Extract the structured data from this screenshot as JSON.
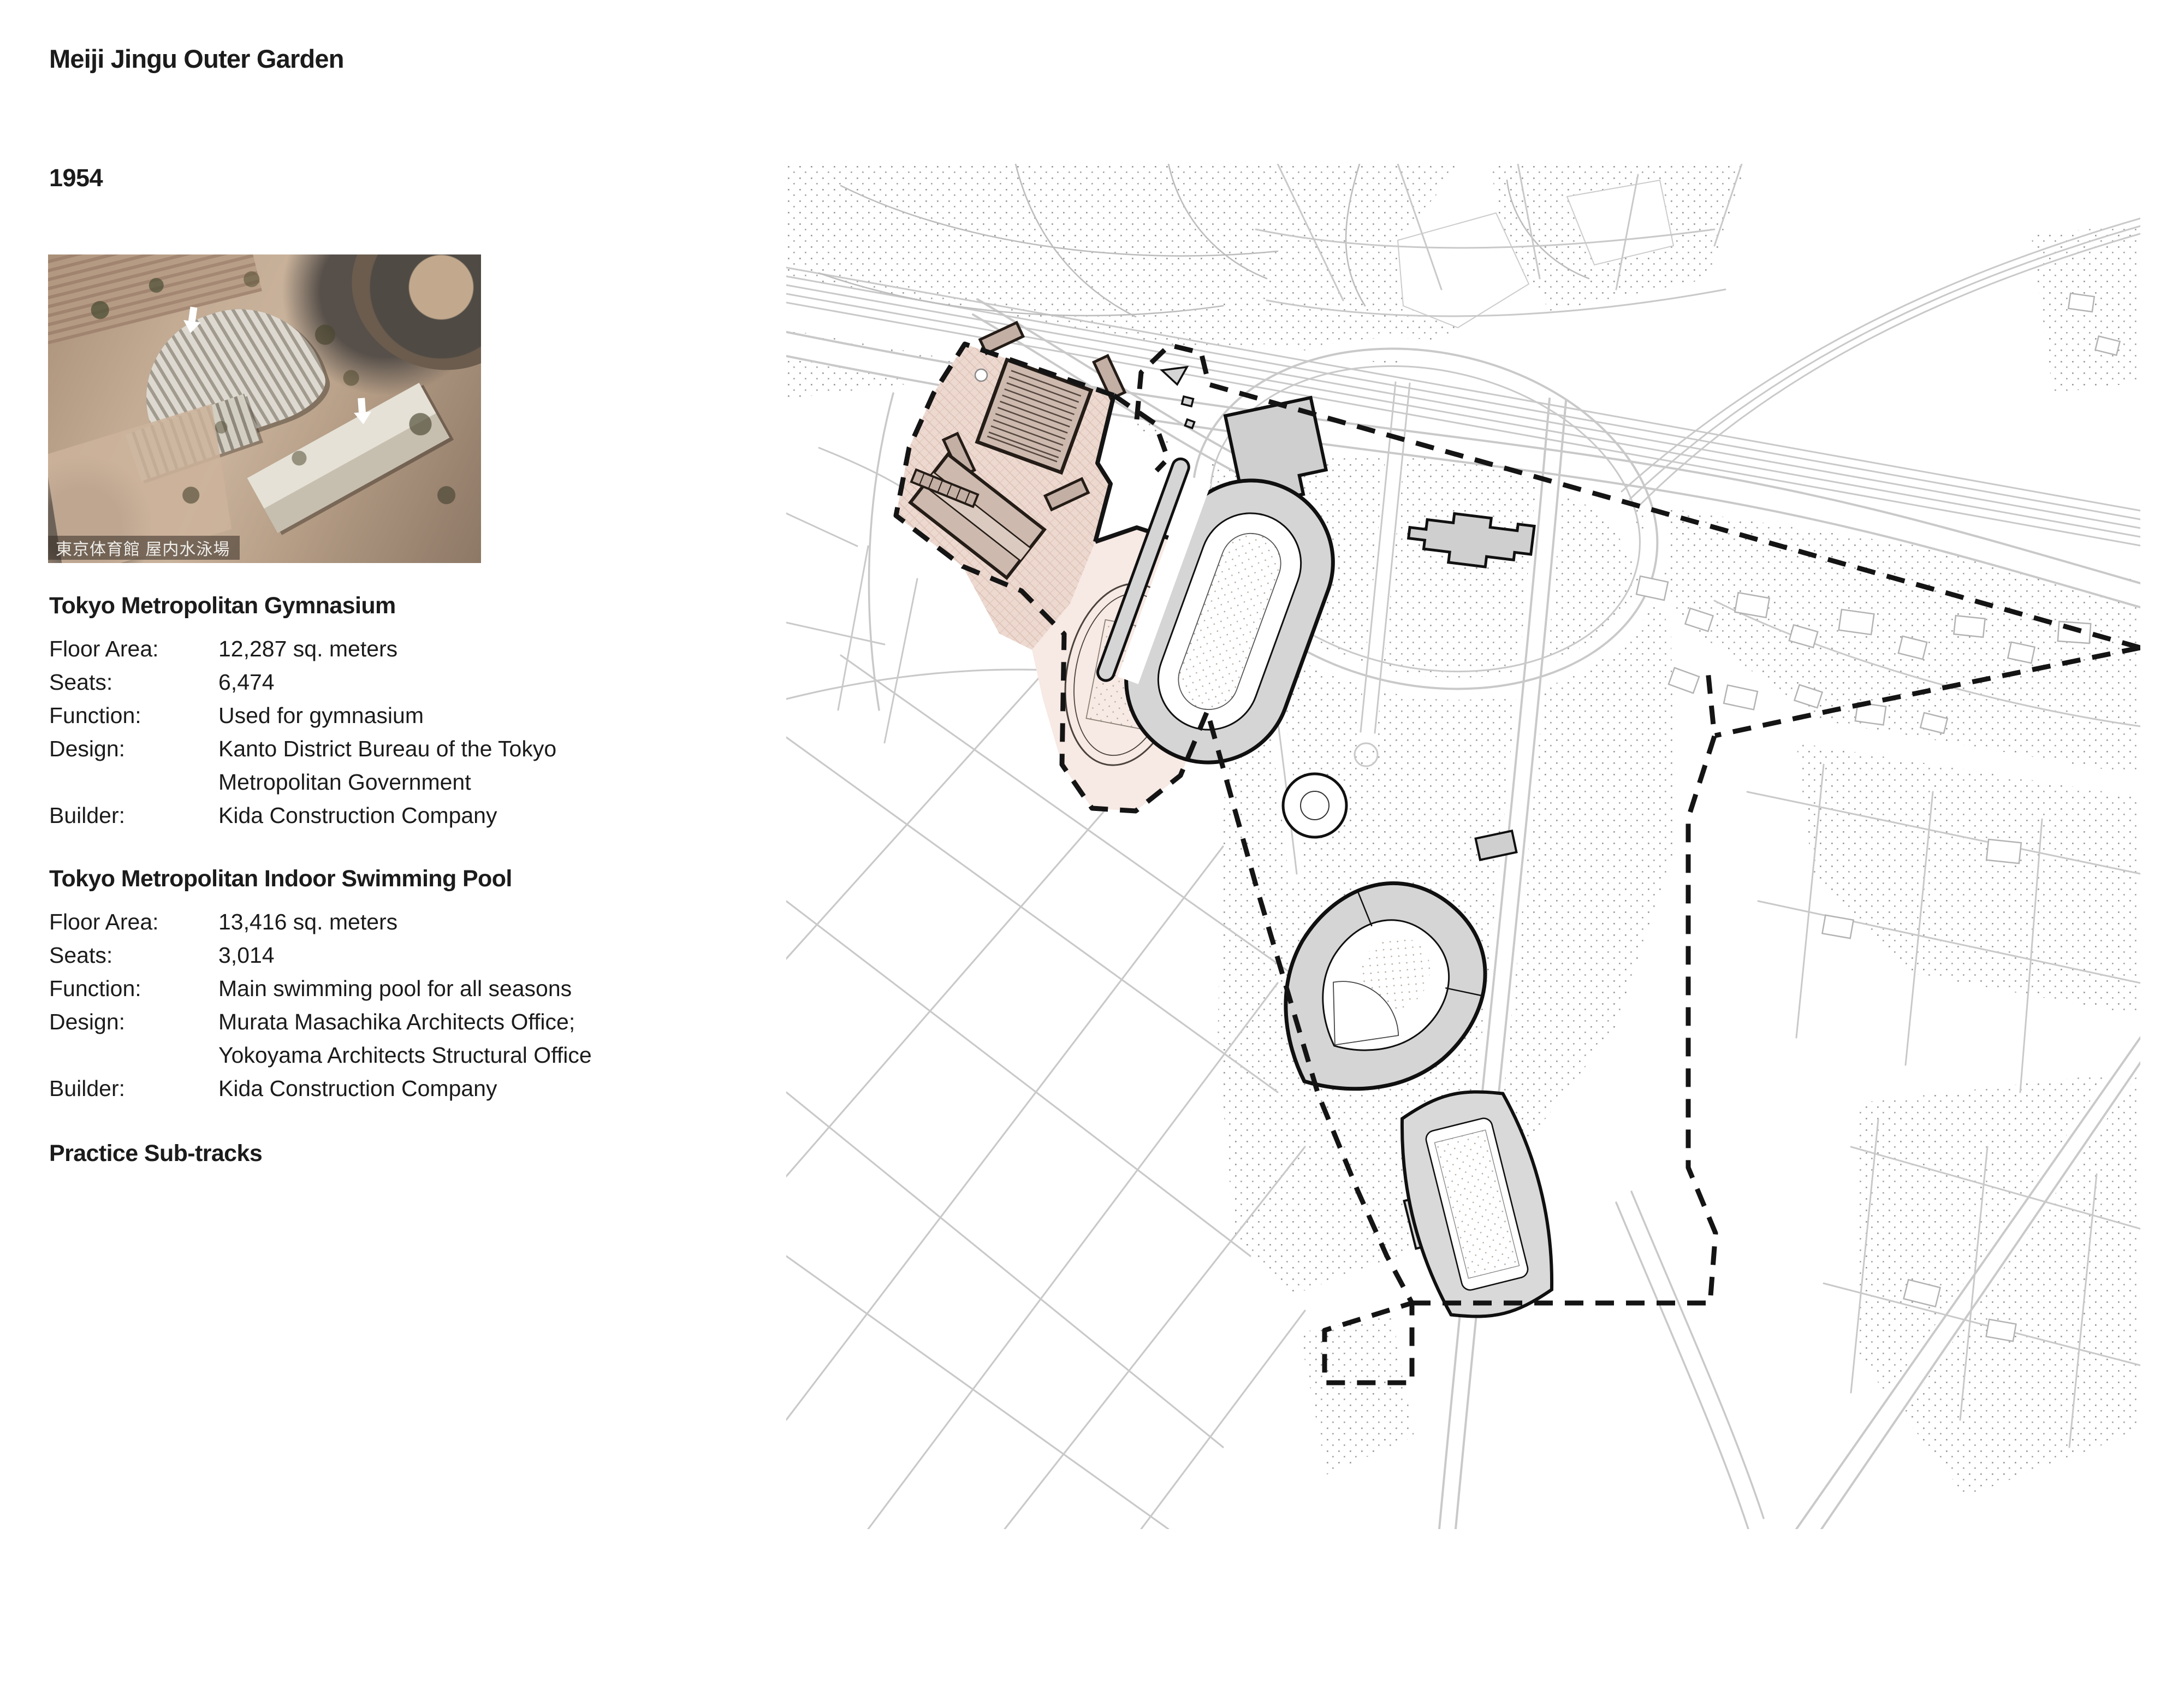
{
  "header": {
    "title": "Meiji Jingu Outer Garden",
    "year": "1954"
  },
  "photo": {
    "caption": "東京体育館 屋内水泳場"
  },
  "sections": [
    {
      "heading": "Tokyo Metropolitan Gymnasium",
      "rows": [
        {
          "label": "Floor Area:",
          "value": "12,287 sq. meters"
        },
        {
          "label": "Seats:",
          "value": "6,474"
        },
        {
          "label": "Function:",
          "value": "Used for gymnasium"
        },
        {
          "label": "Design:",
          "value": "Kanto District Bureau of the Tokyo\nMetropolitan Government"
        },
        {
          "label": "Builder:",
          "value": "Kida Construction Company"
        }
      ]
    },
    {
      "heading": "Tokyo Metropolitan Indoor Swimming Pool",
      "rows": [
        {
          "label": "Floor Area:",
          "value": "13,416 sq. meters"
        },
        {
          "label": "Seats:",
          "value": "3,014"
        },
        {
          "label": "Function:",
          "value": "Main swimming pool for all seasons"
        },
        {
          "label": "Design:",
          "value": "Murata Masachika Architects Office;\nYokoyama Architects Structural Office"
        },
        {
          "label": "Builder:",
          "value": "Kida Construction Company"
        }
      ]
    }
  ],
  "subtracks_heading": "Practice Sub-tracks",
  "map": {
    "features": [
      "site-boundary-dashed",
      "gymnasium-site-hatched",
      "tokyo-metropolitan-gymnasium-building",
      "indoor-swimming-pool-building",
      "practice-sub-track-oval",
      "athletics-stadium",
      "baseball-stadium",
      "rugby-stadium",
      "memorial-picture-gallery",
      "fountain",
      "railway"
    ],
    "colors": {
      "site_hatch": "#edd9d0",
      "site_light": "#f7e9e3",
      "site_building": "#cbb6aa",
      "stadium_gray": "#d5d5d5",
      "boundary": "#141414",
      "road_gray": "#c9c9c9",
      "stipple": "#9a9a9a"
    }
  }
}
